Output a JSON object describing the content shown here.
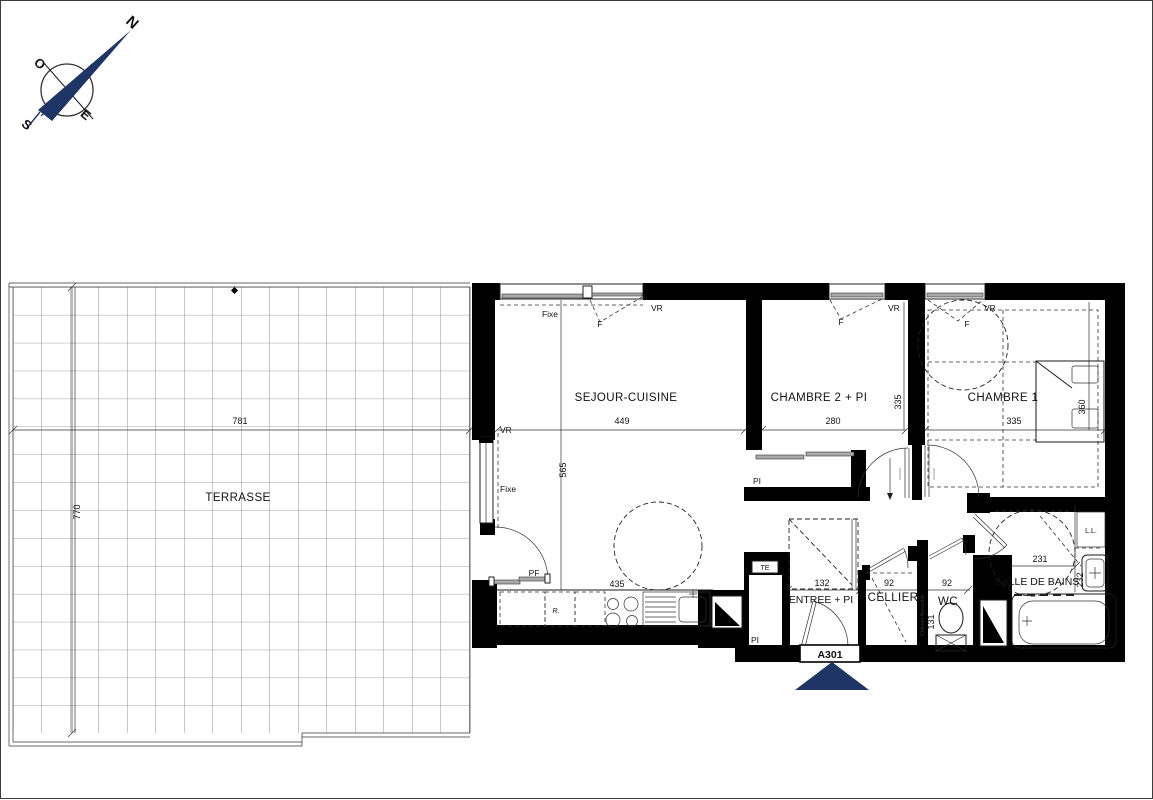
{
  "colors": {
    "navy": "#1f3566",
    "wall": "#000000"
  },
  "compass": {
    "north": "N",
    "west": "O",
    "east": "E",
    "south": "S"
  },
  "unit": {
    "code": "A301"
  },
  "rooms": {
    "terrasse": {
      "name": "TERRASSE",
      "dim_width": "781",
      "dim_height": "770"
    },
    "sejour": {
      "name": "SEJOUR-CUISINE",
      "dim_width": "449",
      "dim_height": "565",
      "dim_kitchen": "435"
    },
    "chambre2": {
      "name": "CHAMBRE 2 + PI",
      "dim_width": "280",
      "dim_height": "335"
    },
    "chambre1": {
      "name": "CHAMBRE 1",
      "dim_width": "335",
      "dim_height": "360"
    },
    "entree": {
      "name": "ENTREE + PI",
      "dim_width": "132"
    },
    "cellier": {
      "name": "CELLIER",
      "dim_width": "92"
    },
    "wc": {
      "name": "WC",
      "dim_width": "92",
      "dim_height": "131"
    },
    "salle_de_bains": {
      "name": "SALLE DE BAINS",
      "dim_width": "231",
      "dim_height": "232"
    }
  },
  "labels": {
    "vr": "VR",
    "fixe": "Fixe",
    "window_f": "F",
    "pf": "PF",
    "te": "TE",
    "pi": "PI",
    "fridge": "R.",
    "washer": "L.L.",
    "partition": "Cloison Amovible"
  }
}
